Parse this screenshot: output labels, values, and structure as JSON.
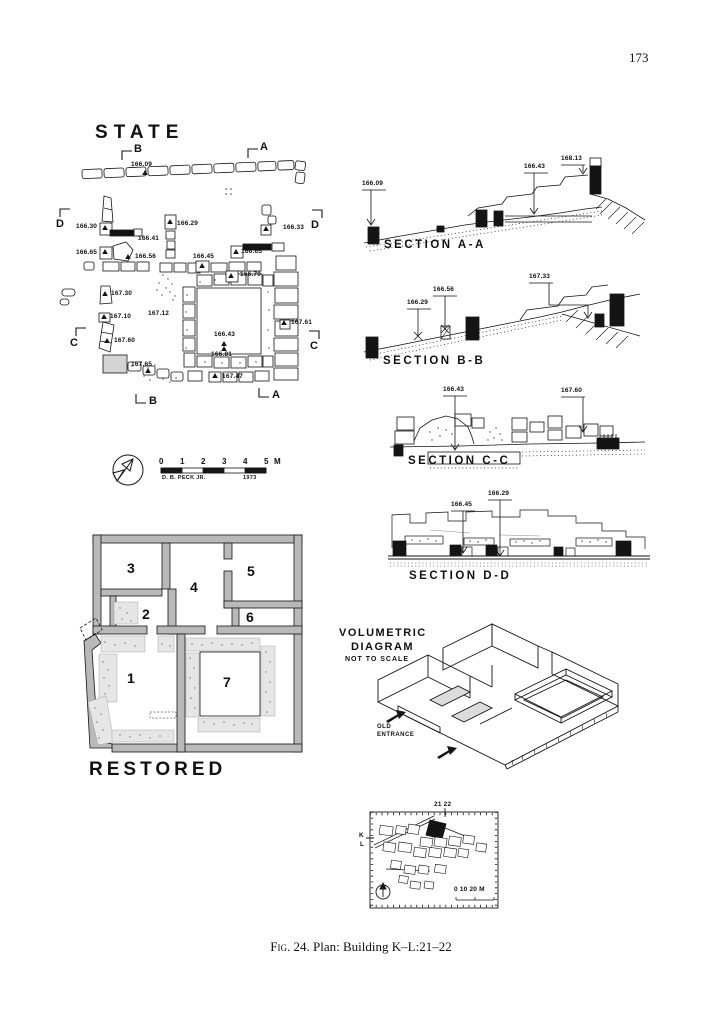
{
  "page": {
    "number": "173",
    "caption_label": "Fig. 24.",
    "caption_text": " Plan: Building K–L:21–22"
  },
  "colors": {
    "ink": "#141414",
    "wall_gray": "#b9b9b9",
    "stipple_gray": "#e6e6e6"
  },
  "state_plan": {
    "title": "STATE",
    "section_markers": {
      "top_b": "B",
      "top_a": "A",
      "left_d": "D",
      "right_d": "D",
      "left_c": "C",
      "right_c": "C",
      "bottom_b": "B",
      "bottom_a": "A"
    },
    "elevations": [
      "166.09",
      "166.30",
      "166.29",
      "166.33",
      "166.41",
      "166.65",
      "166.56",
      "166.45",
      "166.65",
      "166.70",
      "167.30",
      "167.10",
      "167.12",
      "167.61",
      "167.60",
      "166.43",
      "166.81",
      "167.65",
      "167.47"
    ]
  },
  "scale_bar": {
    "ticks": [
      "0",
      "1",
      "2",
      "3",
      "4",
      "5"
    ],
    "unit": "M",
    "credit": "D. B. PECK JR.",
    "year": "1973"
  },
  "sections": [
    {
      "title": "SECTION A-A",
      "labels": [
        "166.09",
        "166.43",
        "168.13"
      ]
    },
    {
      "title": "SECTION B-B",
      "labels": [
        "166.29",
        "166.56",
        "167.33"
      ]
    },
    {
      "title": "SECTION C-C",
      "labels": [
        "166.43",
        "167.60"
      ]
    },
    {
      "title": "SECTION D-D",
      "labels": [
        "166.45",
        "166.29"
      ]
    }
  ],
  "restored_plan": {
    "title": "RESTORED",
    "rooms": [
      "1",
      "2",
      "3",
      "4",
      "5",
      "6",
      "7"
    ]
  },
  "volumetric": {
    "title_line1": "VOLUMETRIC",
    "title_line2": "DIAGRAM",
    "subtitle": "NOT TO SCALE",
    "entrance_line1": "OLD",
    "entrance_line2": "ENTRANCE"
  },
  "site_map": {
    "grid_cols": "21 22",
    "grid_row_top": "K",
    "grid_row_bottom": "L",
    "scale_text": "0   10   20 M"
  }
}
